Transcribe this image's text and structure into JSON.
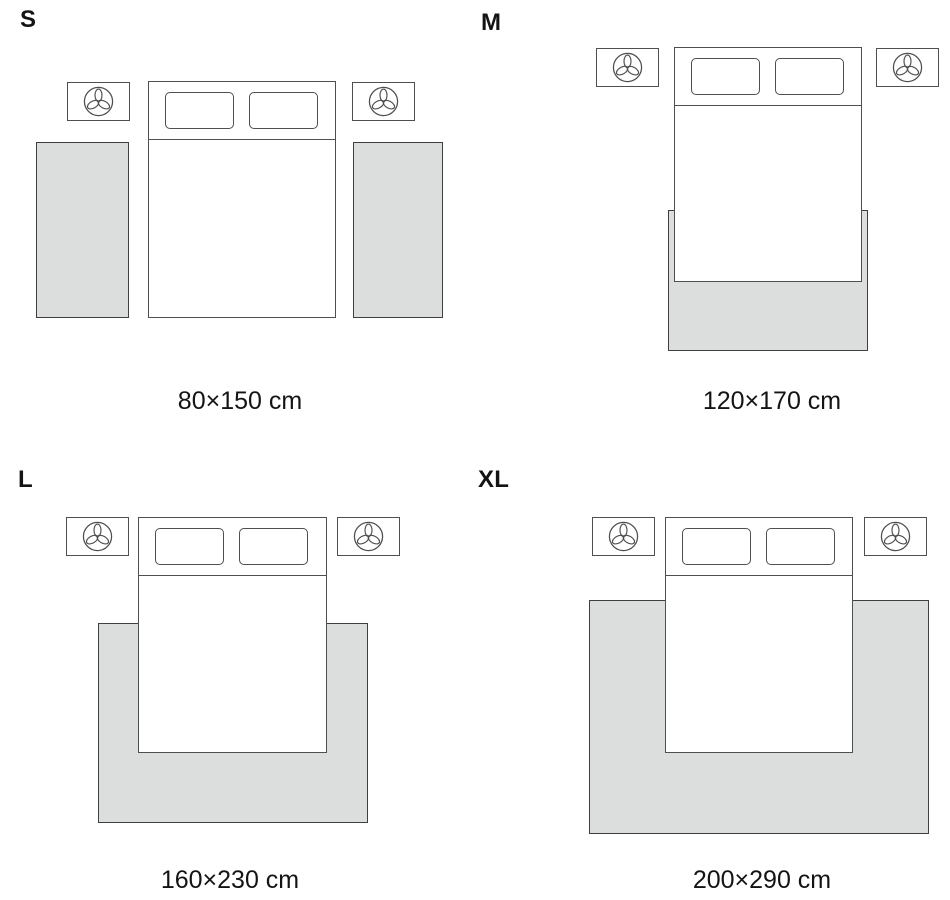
{
  "colors": {
    "background": "#ffffff",
    "rug_fill": "#dcdddd",
    "outline": "#4f4f4f",
    "rug_outline": "#3f3f3f",
    "text": "#141414"
  },
  "icons": {
    "nightstand_decor": "plant-icon"
  },
  "sizes": [
    {
      "id": "s",
      "label": "S",
      "dimensions": "80×150 cm",
      "layout_description": "two runner rugs on either side of bed"
    },
    {
      "id": "m",
      "label": "M",
      "dimensions": "120×170 cm",
      "layout_description": "rug under lower part of bed"
    },
    {
      "id": "l",
      "label": "L",
      "dimensions": "160×230 cm",
      "layout_description": "rug under lower two thirds of bed, extending on three sides"
    },
    {
      "id": "xl",
      "label": "XL",
      "dimensions": "200×290 cm",
      "layout_description": "large rug under bed, extending widely on three sides"
    }
  ]
}
